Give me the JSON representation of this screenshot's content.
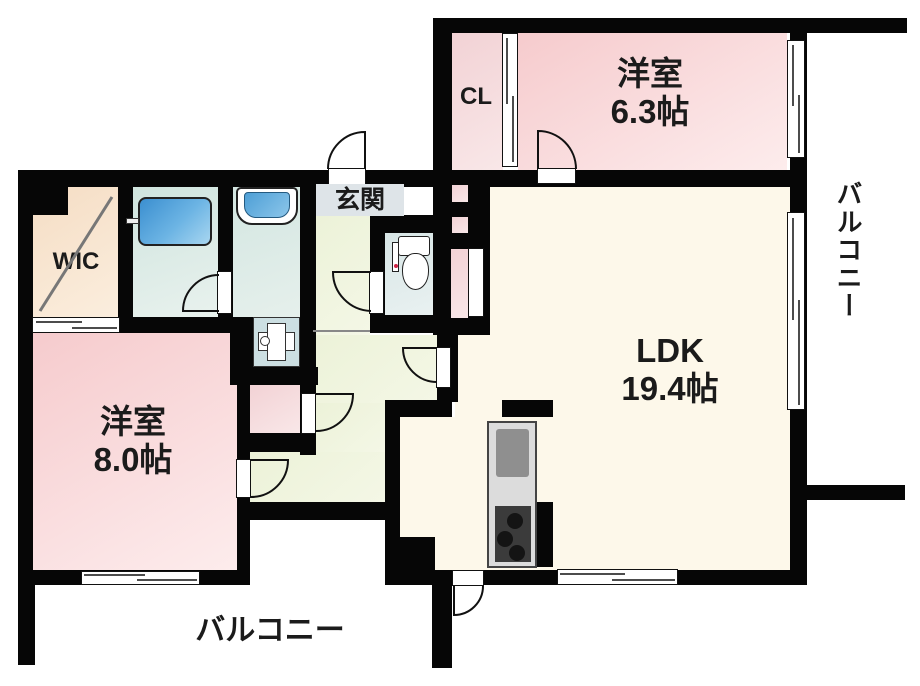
{
  "title": "apartment-floorplan",
  "rooms": {
    "bedroom_63": {
      "label": "洋室",
      "size": "6.3帖"
    },
    "bedroom_80": {
      "label": "洋室",
      "size": "8.0帖"
    },
    "ldk": {
      "label": "LDK",
      "size": "19.4帖"
    },
    "wic": {
      "label": "WIC"
    },
    "closet": {
      "label": "CL"
    },
    "entrance": {
      "label": "玄関"
    },
    "balcony_right": {
      "label": "バルコニー"
    },
    "balcony_bottom": {
      "label": "バルコニー"
    }
  },
  "fixtures": [
    "bathtub",
    "vanity-unit",
    "washbasin",
    "toilet",
    "kitchen-counter",
    "kitchen-sink",
    "gas-stove"
  ],
  "colors": {
    "wall": "#060606",
    "bedroom_pink": "#f6cbcd",
    "ldk_cream": "#fdf8ea",
    "hallway_green": "#ecf2d8",
    "wic_beige": "#f5ddc4",
    "bath_aqua": "#cfe4de",
    "bathtub_blue": "#3b8fd0",
    "entrance_label_bg": "#dee4e8",
    "kitchen_gray": "#dcdcdc",
    "stove_dark": "#3b3b3b"
  }
}
